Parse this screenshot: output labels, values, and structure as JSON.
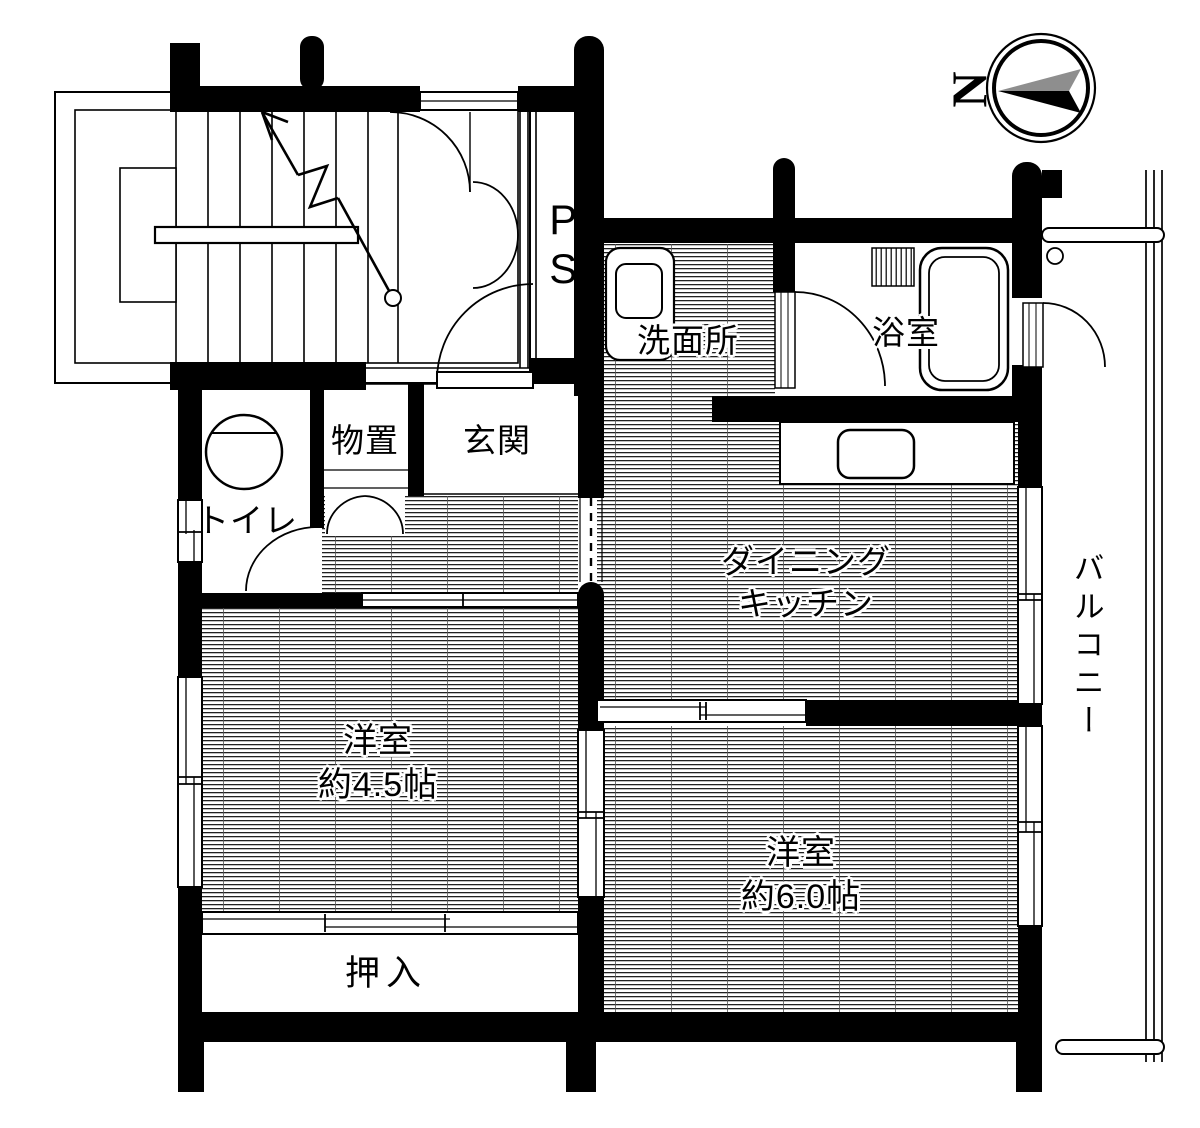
{
  "floorplan": {
    "compass": {
      "north_label": "N"
    },
    "labels": {
      "pipe_space": "PS",
      "washroom": "洗面所",
      "bathroom": "浴室",
      "storage": "物置",
      "entrance": "玄関",
      "toilet": "トイレ",
      "dining_kitchen": [
        "ダイニング",
        "キッチン"
      ],
      "balcony": "バルコニー",
      "western_room_small": [
        "洋室",
        "約4.5帖"
      ],
      "western_room_large": [
        "洋室",
        "約6.0帖"
      ],
      "closet": "押入"
    },
    "colors": {
      "wall": "#000000",
      "background": "#ffffff",
      "compass_arrow_north": "#000000",
      "compass_arrow_tail": "#8e8e8e"
    }
  }
}
